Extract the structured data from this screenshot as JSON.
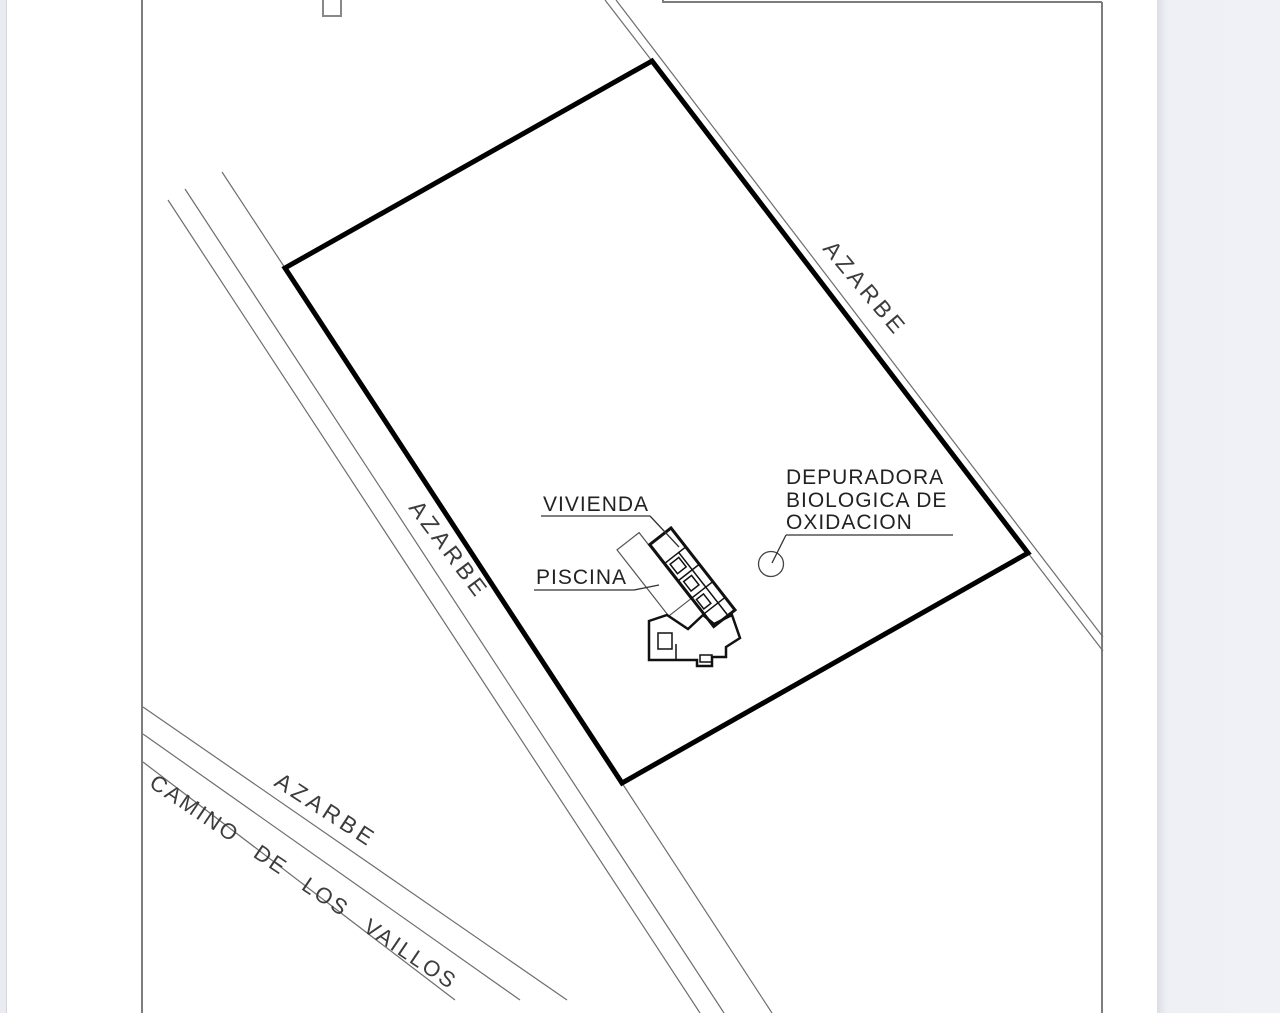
{
  "plan": {
    "street_labels": {
      "azarbe_left": "AZARBE",
      "azarbe_right": "AZARBE",
      "azarbe_bottom": "AZARBE",
      "camino": "CAMINO DE LOS VAILLOS"
    },
    "feature_labels": {
      "vivienda": "VIVIENDA",
      "piscina": "PISCINA",
      "depuradora_l1": "DEPURADORA",
      "depuradora_l2": "BIOLOGICA DE",
      "depuradora_l3": "OXIDACION"
    },
    "colors": {
      "page_background": "#ffffff",
      "margin_background": "#eef0f6",
      "parcel_boundary": "#000000",
      "road_line": "#6e6e6e",
      "frame_line": "#7d7d7d",
      "label_text": "#2e2e2e"
    }
  }
}
